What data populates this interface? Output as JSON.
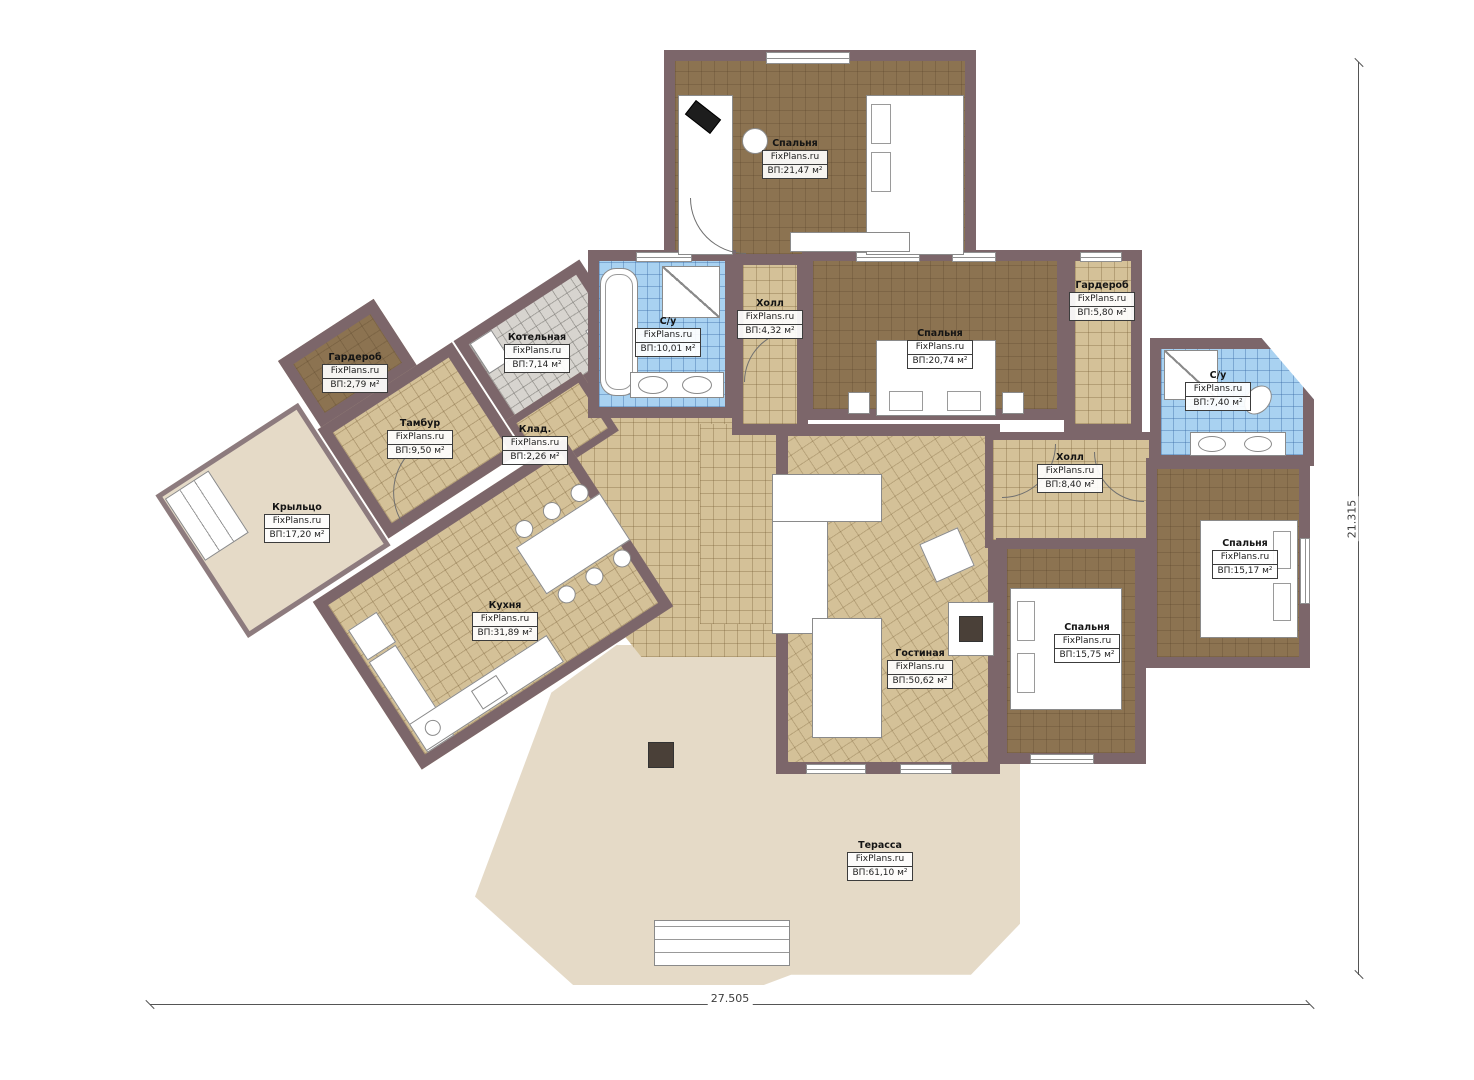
{
  "title": "План этажа",
  "brand": "FixPlans.ru",
  "dimensions": {
    "width_label": "27.505",
    "height_label": "21.315"
  },
  "colors": {
    "wall": "#7c666a",
    "floor_dark": "#8c7351",
    "floor_tan": "#d4c198",
    "floor_blue": "#a9d2f1",
    "floor_gray": "#d7d4cf",
    "terrace": "#e5dac7"
  },
  "rooms": [
    {
      "name": "Спальня",
      "area": "ВП:21,47 м²"
    },
    {
      "name": "Гардероб",
      "area": "ВП:2,79 м²"
    },
    {
      "name": "Котельная",
      "area": "ВП:7,14 м²"
    },
    {
      "name": "С/у",
      "area": "ВП:10,01 м²"
    },
    {
      "name": "Холл",
      "area": "ВП:4,32 м²"
    },
    {
      "name": "Спальня",
      "area": "ВП:20,74 м²"
    },
    {
      "name": "Гардероб",
      "area": "ВП:5,80 м²"
    },
    {
      "name": "С/у",
      "area": "ВП:7,40 м²"
    },
    {
      "name": "Тамбур",
      "area": "ВП:9,50 м²"
    },
    {
      "name": "Клад.",
      "area": "ВП:2,26 м²"
    },
    {
      "name": "Крыльцо",
      "area": "ВП:17,20 м²"
    },
    {
      "name": "Кухня",
      "area": "ВП:31,89 м²"
    },
    {
      "name": "Холл",
      "area": "ВП:8,40 м²"
    },
    {
      "name": "Спальня",
      "area": "ВП:15,17 м²"
    },
    {
      "name": "Спальня",
      "area": "ВП:15,75 м²"
    },
    {
      "name": "Гостиная",
      "area": "ВП:50,62 м²"
    },
    {
      "name": "Терасса",
      "area": "ВП:61,10 м²"
    }
  ]
}
